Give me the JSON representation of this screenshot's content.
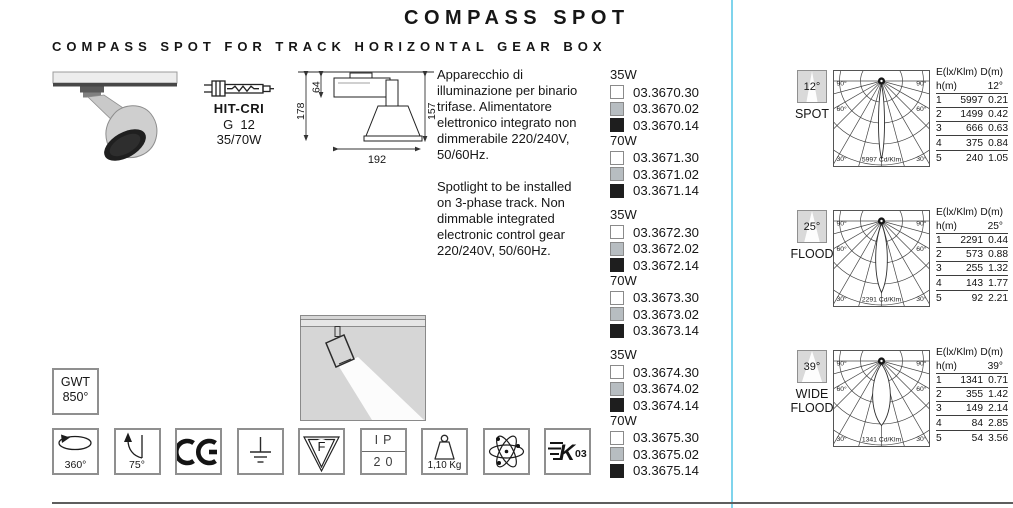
{
  "header": {
    "title": "COMPASS SPOT",
    "subtitle": "COMPASS SPOT FOR TRACK HORIZONTAL GEAR BOX"
  },
  "lamp": {
    "type": "HIT-CRI",
    "base": "G  12",
    "wattage": "35/70W"
  },
  "dimensions": {
    "total_height": "178",
    "box_height": "64",
    "body_height": "157",
    "width": "192"
  },
  "description": {
    "italian": "Apparecchio di\nilluminazione per binario\ntrifase. Alimentatore\nelettronico integrato non\ndimmerabile 220/240V,\n50/60Hz.",
    "english": "Spotlight to be installed\non 3-phase track. Non\ndimmable integrated\nelectronic control gear\n220/240V, 50/60Hz."
  },
  "finishes": {
    "white": "#ffffff",
    "grey": "#b7bdc1",
    "black": "#1e1e1e",
    "swatch_border": "#8a8a8a"
  },
  "code_blocks": [
    {
      "sections": [
        {
          "wattage": "35W",
          "codes": [
            {
              "finish": "white",
              "code": "03.3670.30"
            },
            {
              "finish": "grey",
              "code": "03.3670.02"
            },
            {
              "finish": "black",
              "code": "03.3670.14"
            }
          ]
        },
        {
          "wattage": "70W",
          "codes": [
            {
              "finish": "white",
              "code": "03.3671.30"
            },
            {
              "finish": "grey",
              "code": "03.3671.02"
            },
            {
              "finish": "black",
              "code": "03.3671.14"
            }
          ]
        }
      ]
    },
    {
      "sections": [
        {
          "wattage": "35W",
          "codes": [
            {
              "finish": "white",
              "code": "03.3672.30"
            },
            {
              "finish": "grey",
              "code": "03.3672.02"
            },
            {
              "finish": "black",
              "code": "03.3672.14"
            }
          ]
        },
        {
          "wattage": "70W",
          "codes": [
            {
              "finish": "white",
              "code": "03.3673.30"
            },
            {
              "finish": "grey",
              "code": "03.3673.02"
            },
            {
              "finish": "black",
              "code": "03.3673.14"
            }
          ]
        }
      ]
    },
    {
      "sections": [
        {
          "wattage": "35W",
          "codes": [
            {
              "finish": "white",
              "code": "03.3674.30"
            },
            {
              "finish": "grey",
              "code": "03.3674.02"
            },
            {
              "finish": "black",
              "code": "03.3674.14"
            }
          ]
        },
        {
          "wattage": "70W",
          "codes": [
            {
              "finish": "white",
              "code": "03.3675.30"
            },
            {
              "finish": "grey",
              "code": "03.3675.02"
            },
            {
              "finish": "black",
              "code": "03.3675.14"
            }
          ]
        }
      ]
    }
  ],
  "gwt": {
    "line1": "GWT",
    "line2": "850°"
  },
  "icons": [
    {
      "name": "rotation-360-icon",
      "label": "360°"
    },
    {
      "name": "tilt-75-icon",
      "label": "75°"
    },
    {
      "name": "ce-mark-icon",
      "label": "CE"
    },
    {
      "name": "earth-ground-icon",
      "label": ""
    },
    {
      "name": "f-mark-icon",
      "label": "F"
    },
    {
      "name": "ip-rating-icon",
      "label_top": "IP",
      "label_bottom": "20"
    },
    {
      "name": "weight-icon",
      "label": "1,10 Kg"
    },
    {
      "name": "atom-icon",
      "label": ""
    },
    {
      "name": "k03-icon",
      "mark": "K",
      "label": "03"
    }
  ],
  "photometry_common": {
    "angle_labels": [
      "90°",
      "60°",
      "30°"
    ],
    "col_e": "E(lx/Klm)",
    "col_d": "D(m)",
    "col_h": "h(m)"
  },
  "photometry": [
    {
      "beam": "12°",
      "beam_deg": 12,
      "name": "SPOT",
      "cd_klm": "5997 Cd/Klm",
      "angle": "12°",
      "rows": [
        [
          "1",
          "5997",
          "0.21"
        ],
        [
          "2",
          "1499",
          "0.42"
        ],
        [
          "3",
          "666",
          "0.63"
        ],
        [
          "4",
          "375",
          "0.84"
        ],
        [
          "5",
          "240",
          "1.05"
        ]
      ]
    },
    {
      "beam": "25°",
      "beam_deg": 25,
      "name": "FLOOD",
      "cd_klm": "2291 Cd/Klm",
      "angle": "25°",
      "rows": [
        [
          "1",
          "2291",
          "0.44"
        ],
        [
          "2",
          "573",
          "0.88"
        ],
        [
          "3",
          "255",
          "1.32"
        ],
        [
          "4",
          "143",
          "1.77"
        ],
        [
          "5",
          "92",
          "2.21"
        ]
      ]
    },
    {
      "beam": "39°",
      "beam_deg": 39,
      "name": "WIDE FLOOD",
      "cd_klm": "1341 Cd/Klm",
      "angle": "39°",
      "rows": [
        [
          "1",
          "1341",
          "0.71"
        ],
        [
          "2",
          "355",
          "1.42"
        ],
        [
          "3",
          "149",
          "2.14"
        ],
        [
          "4",
          "84",
          "2.85"
        ],
        [
          "5",
          "54",
          "3.56"
        ]
      ]
    }
  ]
}
